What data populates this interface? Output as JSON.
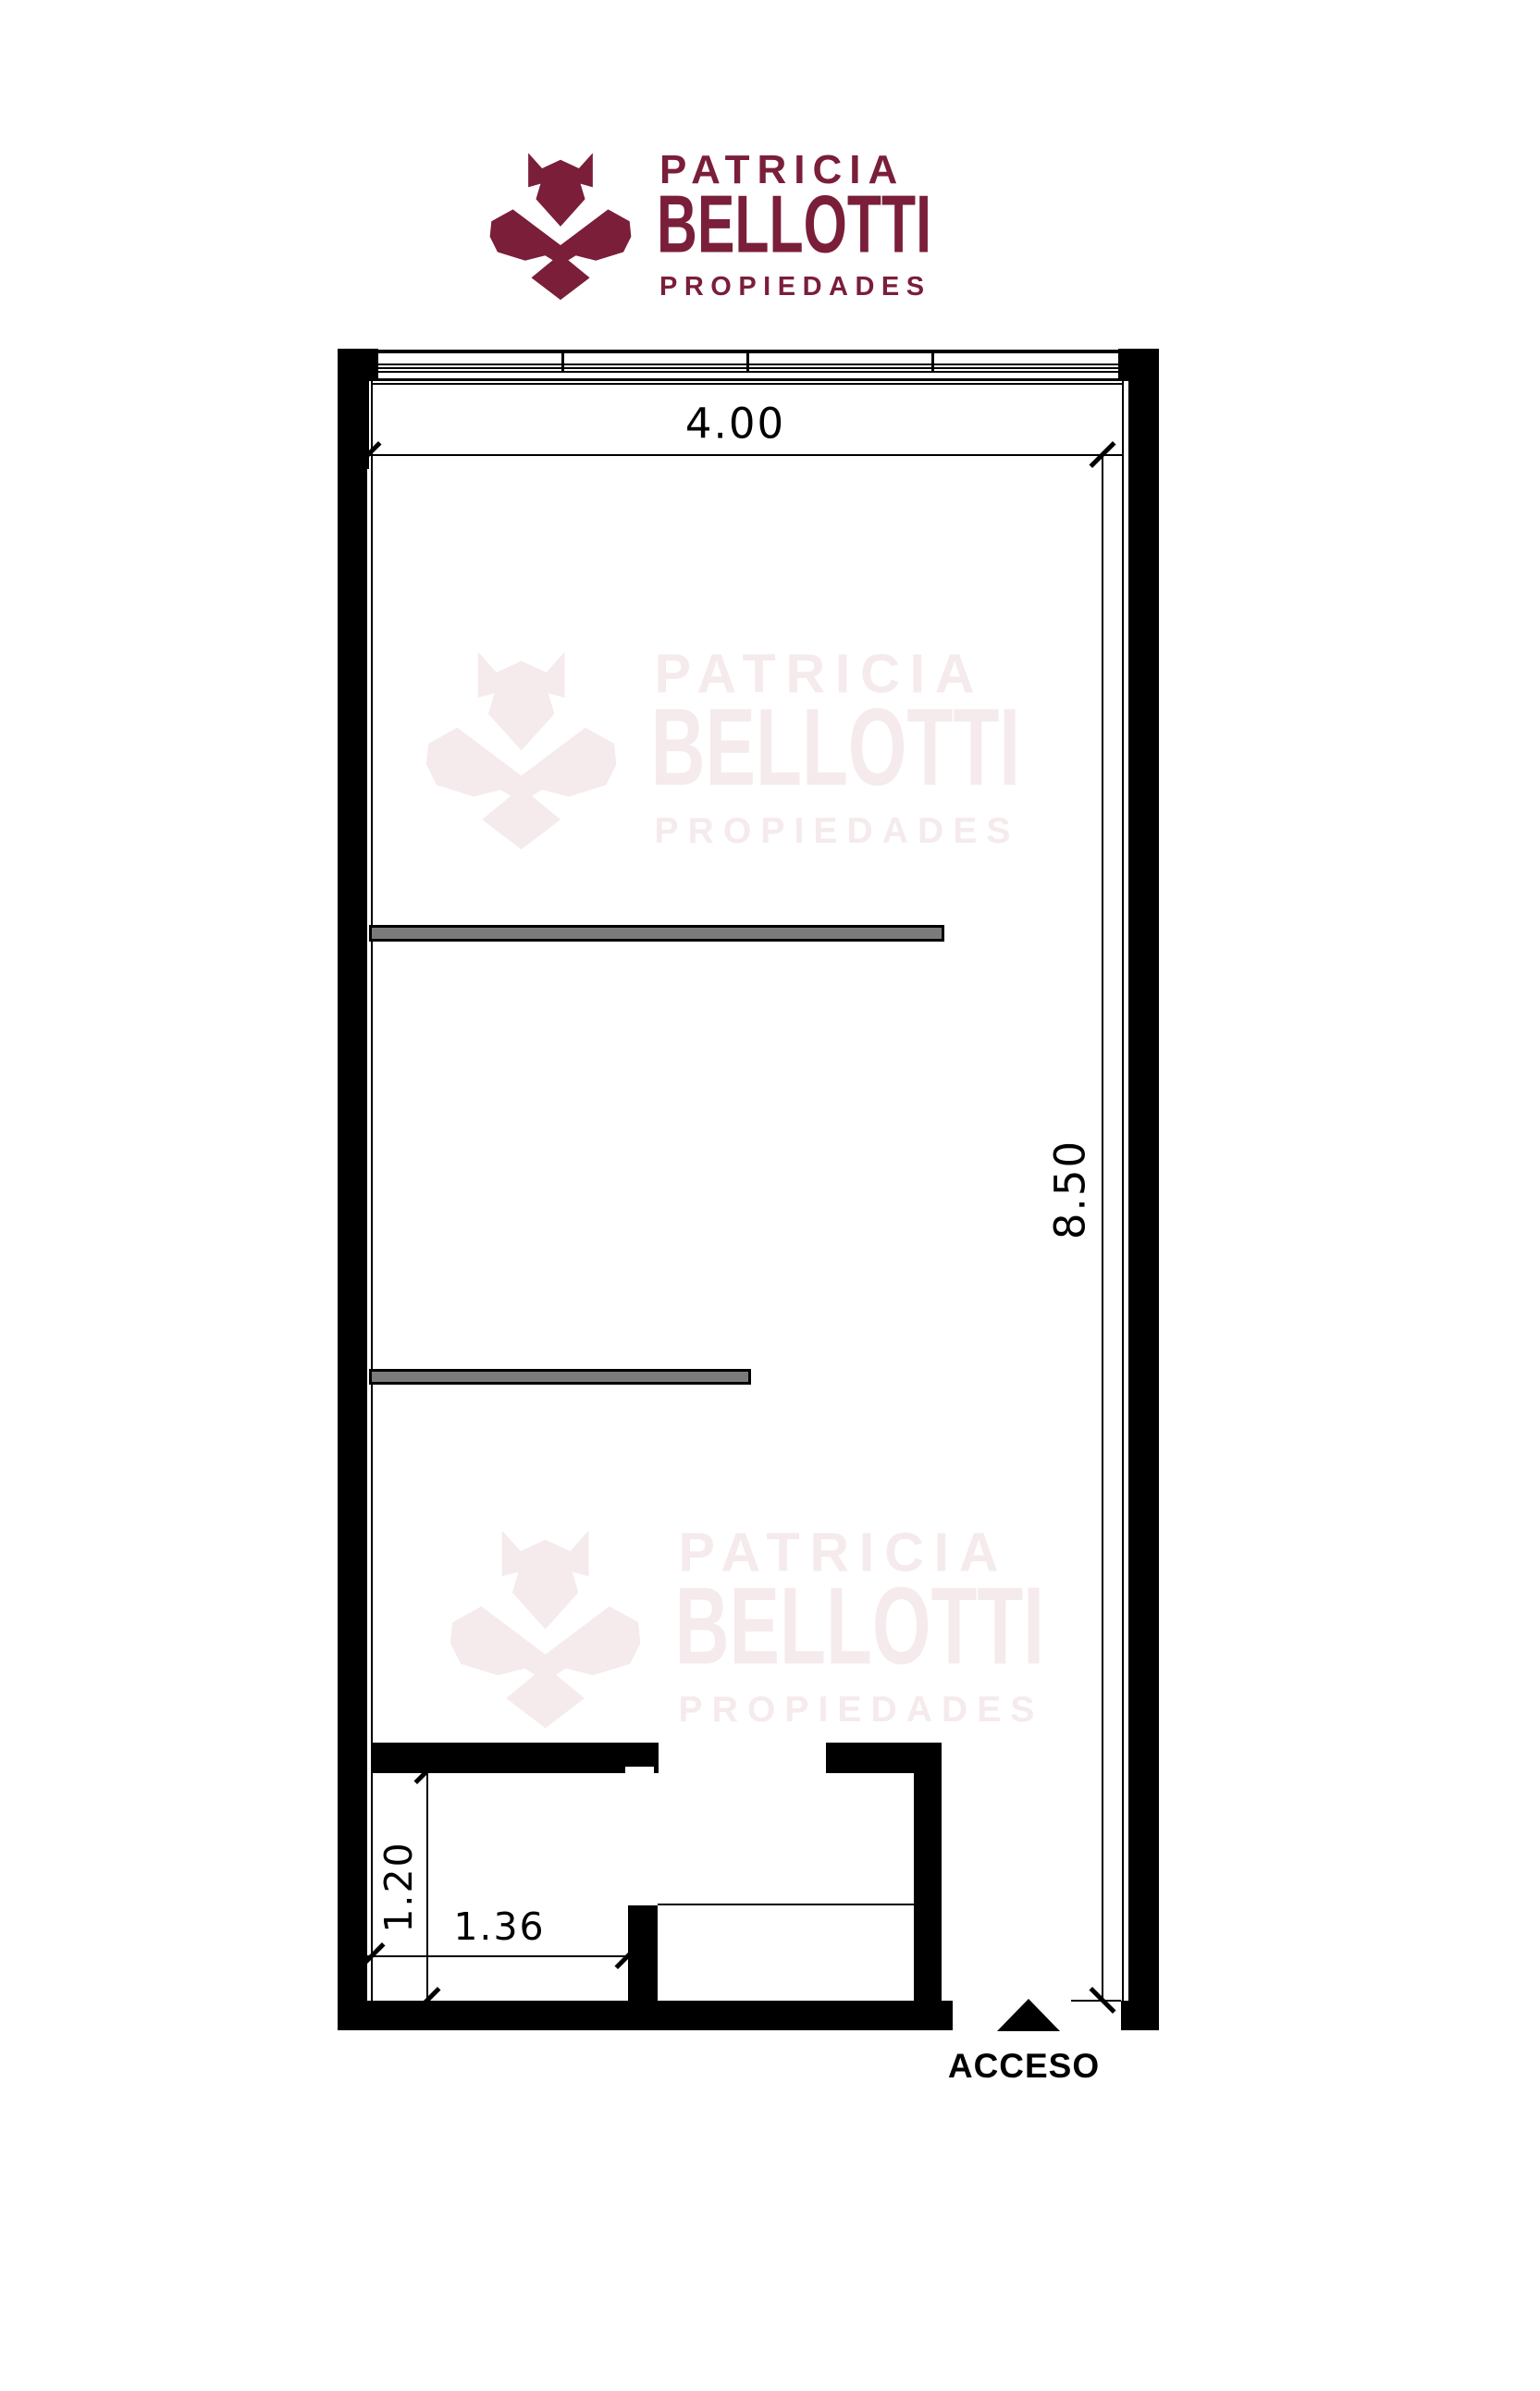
{
  "brand": {
    "name_top": "PATRICIA",
    "name_main": "BELLOTTI",
    "tagline": "PROPIEDADES"
  },
  "plan": {
    "dim_top_width": "4.00",
    "dim_right_height": "8.50",
    "dim_bath_height": "1.20",
    "dim_bath_width": "1.36",
    "access_label": "ACCESO"
  },
  "colors": {
    "brand": "#7a1e3a",
    "watermark": "#f5eaec",
    "wall": "#000000",
    "partition": "#7b7b7b"
  }
}
